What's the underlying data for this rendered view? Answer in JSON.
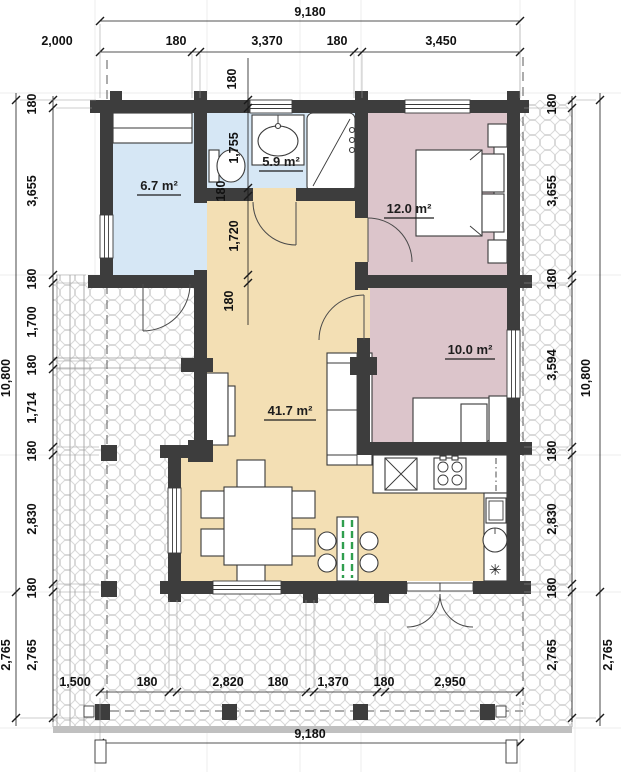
{
  "rooms": {
    "entry_area": "6.7 m²",
    "bath_area": "5.9 m²",
    "bedroom1_area": "12.0 m²",
    "bedroom2_area": "10.0 m²",
    "living_area": "41.7 m²"
  },
  "dims": {
    "top_overall": "9,180",
    "top": [
      "2,000",
      "180",
      "3,370",
      "180",
      "3,450"
    ],
    "mid": [
      "180",
      "1,755",
      "180",
      "1,720",
      "180"
    ],
    "left": [
      "180",
      "3,655",
      "180",
      "1,700",
      "180",
      "1,714",
      "180",
      "2,830",
      "180",
      "2,765"
    ],
    "left_outer_total": "10,800",
    "left_outer_terrace": "2,765",
    "right": [
      "180",
      "3,655",
      "180",
      "3,594",
      "180",
      "2,830",
      "180",
      "2,765"
    ],
    "right_outer_total": "10,800",
    "right_outer_terrace": "2,765",
    "bottom": [
      "1,500",
      "180",
      "2,820",
      "180",
      "1,370",
      "180",
      "2,950"
    ],
    "bottom_overall": "9,180"
  },
  "symbols": {
    "fridge_mark": "✳"
  },
  "colors": {
    "wall": "#3d3d3d",
    "entry": "#d6e7f5",
    "bath": "#d6e7f5",
    "bedroom": "#dcc5cb",
    "living": "#f3dfb4",
    "green": "#2f9e4e",
    "terrace_edge": "#c0c0c0"
  }
}
